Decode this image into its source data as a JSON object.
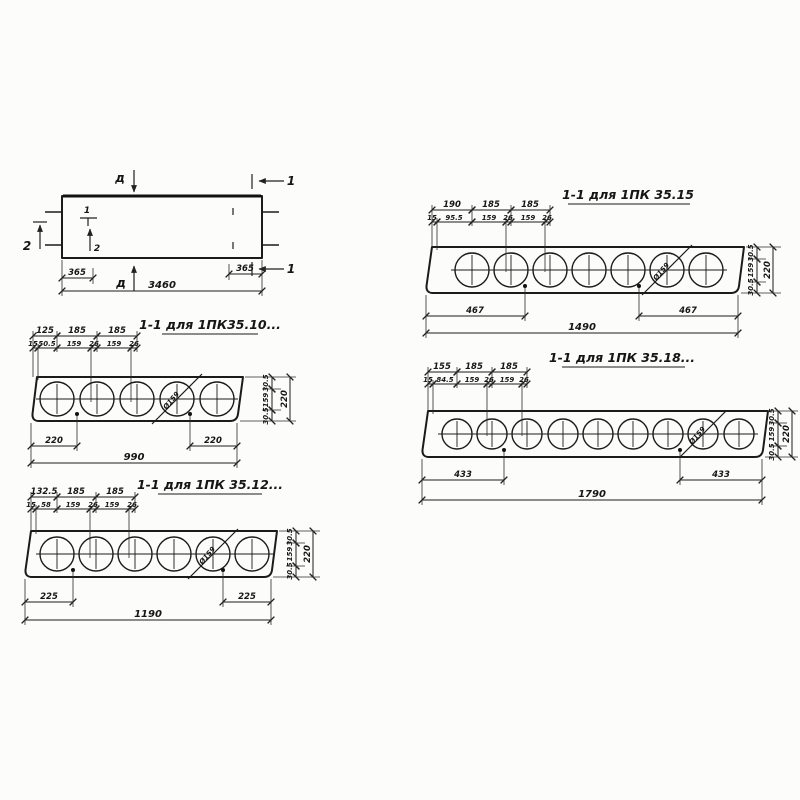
{
  "plan": {
    "overall_length": "3460",
    "offset_left": "365",
    "offset_right": "365",
    "section_marker_top": "д",
    "section_marker_bottom": "д",
    "cut_label": "1",
    "cut_label_2": "2",
    "item_label_1": "1",
    "item_label_2": "2"
  },
  "sections": [
    {
      "title": "1-1 для 1ПК35.10...",
      "core_label": "Ø159",
      "top_dims": [
        "125",
        "185",
        "185"
      ],
      "sub_dims": [
        "15",
        "50.5",
        "159",
        "26",
        "159",
        "26"
      ],
      "bottom_dims": [
        "220",
        "220"
      ],
      "overall_width": "990",
      "side_dims": [
        "30.5",
        "159",
        "30.5"
      ],
      "thickness": "220"
    },
    {
      "title": "1-1 для 1ПК 35.12...",
      "core_label": "Ø159",
      "top_dims": [
        "132.5",
        "185",
        "185"
      ],
      "sub_dims": [
        "15",
        "58",
        "159",
        "26",
        "159",
        "26"
      ],
      "bottom_dims": [
        "225",
        "225"
      ],
      "overall_width": "1190",
      "side_dims": [
        "30.5",
        "159",
        "30.5"
      ],
      "thickness": "220"
    },
    {
      "title": "1-1 для 1ПК 35.15",
      "core_label": "Ø159",
      "top_dims": [
        "190",
        "185",
        "185"
      ],
      "sub_dims": [
        "15",
        "95.5",
        "159",
        "26",
        "159",
        "26"
      ],
      "bottom_dims": [
        "467",
        "467"
      ],
      "overall_width": "1490",
      "side_dims": [
        "30.5",
        "159",
        "30.5"
      ],
      "thickness": "220"
    },
    {
      "title": "1-1 для 1ПК 35.18...",
      "core_label": "Ø159",
      "top_dims": [
        "155",
        "185",
        "185"
      ],
      "sub_dims": [
        "15",
        "84.5",
        "159",
        "26",
        "159",
        "26"
      ],
      "bottom_dims": [
        "433",
        "433"
      ],
      "overall_width": "1790",
      "side_dims": [
        "30.5",
        "159",
        "30.5"
      ],
      "thickness": "220"
    }
  ]
}
